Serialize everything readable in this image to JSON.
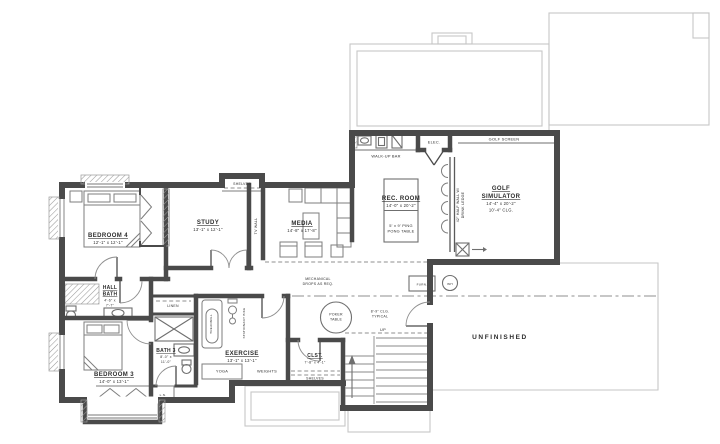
{
  "colors": {
    "wall": "#4a4a4a",
    "furniture_line": "#7d7d7d",
    "light_outline": "#c6c6c6",
    "text": "#2c2c2c",
    "background": "#ffffff"
  },
  "rooms": {
    "bedroom4": {
      "name": "BEDROOM 4",
      "dims": "12'-1\" x 12'-1\""
    },
    "study": {
      "name": "STUDY",
      "dims": "13'-1\" x 12'-1\""
    },
    "media": {
      "name": "MEDIA",
      "dims": "14'-8\" x 17'-8\""
    },
    "rec_room": {
      "name": "REC. ROOM",
      "dims": "14'-0\" x 20'-2\"",
      "table_note_1": "5' x 9' PING",
      "table_note_2": "PONG TABLE"
    },
    "golf_simulator": {
      "name_1": "GOLF",
      "name_2": "SIMULATOR",
      "dims": "14'-4\" x 20'-2\"",
      "ceiling": "10'-4\" CLG."
    },
    "hall_bath": {
      "name_1": "HALL",
      "name_2": "BATH",
      "dims_1": "4'-6\" x",
      "dims_2": "7'-7\""
    },
    "bedroom3": {
      "name": "BEDROOM 3",
      "dims": "14'-0\" x 13'-1\""
    },
    "bath3": {
      "name": "BATH 3",
      "dims_1": "8'-0\" x",
      "dims_2": "11'-0\""
    },
    "exercise": {
      "name": "EXERCISE",
      "dims": "13'-1\" x 13'-1\""
    },
    "closet": {
      "name": "CLST.",
      "dims": "7'-8\" x 4'-1\""
    },
    "unfinished": {
      "name": "UNFINISHED"
    }
  },
  "labels": {
    "walk_up_bar": "WALK-UP BAR",
    "elec": "ELEC.",
    "golf_screen": "GOLF SCREEN",
    "half_wall_1": "42\" HALF WALL W/",
    "half_wall_2": "DRINK LEDGE",
    "tv_wall": "TV WALL",
    "shelves_study": "SHELVES",
    "shelves_closet": "SHELVES",
    "linen": "LINEN",
    "ln": "L.N.",
    "treadmill": "TREADMILL",
    "stationary_bike": "STATIONARY BIKE",
    "yoga": "YOGA",
    "weights": "WEIGHTS",
    "poker_1": "POKER",
    "poker_2": "TABLE",
    "mech_note_1": "MECHANICAL",
    "mech_note_2": "DROPS AS REQ.",
    "ceiling_note_1": "8'-9\" CLG.",
    "ceiling_note_2": "TYPICAL",
    "furnace": "FURN.",
    "water_heater": "WH",
    "stairs_up": "UP"
  }
}
